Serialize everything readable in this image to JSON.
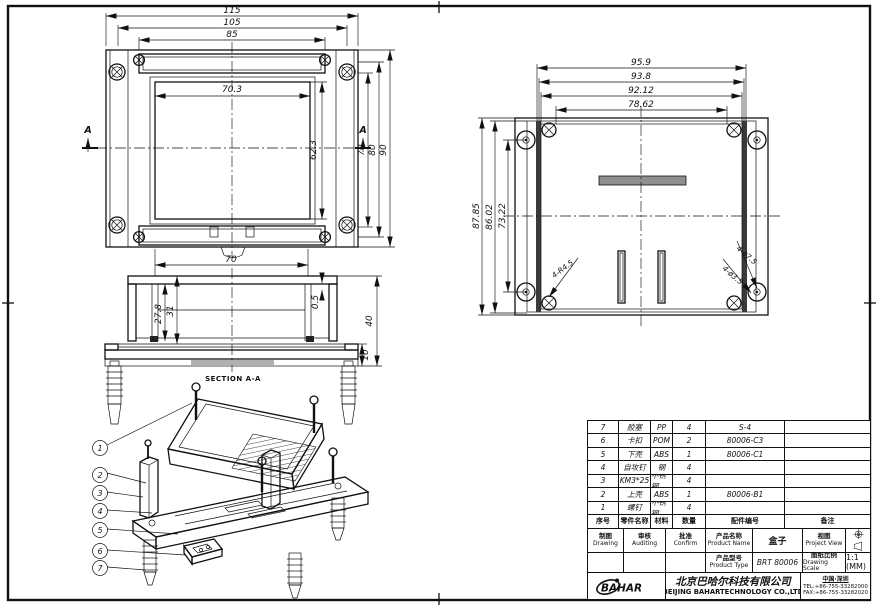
{
  "page": {
    "bg": "#ffffff",
    "line_color": "#111111"
  },
  "dims": {
    "top_view": {
      "overall_w": "115",
      "lid_w": "105",
      "slot_w": "85",
      "inner_w": "70.3",
      "inner_h": "62.3",
      "h1": "70",
      "h2": "80",
      "h3": "90",
      "bottom_w": "70",
      "section_letter": "A"
    },
    "bottom_view": {
      "w1": "95.9",
      "w2": "93.8",
      "w3": "92.12",
      "w4": "78.62",
      "h1": "87.85",
      "h2": "86.02",
      "h3": "73.22",
      "corner_radius": "4-R4.5",
      "boss_dia": "4-ø7.5",
      "hole_dia": "4-ø3.5"
    },
    "section_view": {
      "label": "SECTION A-A",
      "top_w": "70",
      "depth1": "27.8",
      "depth2": "31",
      "gap": "0.5",
      "total_h": "40",
      "base_h": "10"
    }
  },
  "balloons": [
    "1",
    "2",
    "3",
    "4",
    "5",
    "6",
    "7"
  ],
  "bom": {
    "headers": [
      "序号",
      "零件名称",
      "材料",
      "数量",
      "配件编号",
      "备注"
    ],
    "rows": [
      [
        "7",
        "胶塞",
        "PP",
        "4",
        "S-4",
        ""
      ],
      [
        "6",
        "卡扣",
        "POM",
        "2",
        "80006-C3",
        ""
      ],
      [
        "5",
        "下壳",
        "ABS",
        "1",
        "80006-C1",
        ""
      ],
      [
        "4",
        "自攻钉",
        "钢",
        "4",
        "",
        ""
      ],
      [
        "3",
        "KM3*25",
        "不锈钢",
        "4",
        "",
        ""
      ],
      [
        "2",
        "上壳",
        "ABS",
        "1",
        "80006-B1",
        ""
      ],
      [
        "1",
        "螺钉",
        "不锈钢",
        "4",
        "",
        ""
      ]
    ]
  },
  "title_block": {
    "drawing_cn": "制图",
    "drawing_en": "Drawing",
    "auditing_cn": "审核",
    "auditing_en": "Auditing",
    "confirm_cn": "批准",
    "confirm_en": "Confirm",
    "product_name_cn": "产品名称",
    "product_name_en": "Product Name",
    "product_name_value": "盒子",
    "project_view_cn": "视图",
    "project_view_en": "Project View",
    "product_type_cn": "产品型号",
    "product_type_en": "Product Type",
    "product_type_value": "BRT 80006",
    "scale_cn": "图纸比例",
    "scale_en": "Drawing Scale",
    "scale_value": "1:1 (MM)",
    "logo_text": "BAHAR",
    "company_cn": "北京巴哈尔科技有限公司",
    "company_en": "BEIJING BAHARTECHNOLOGY CO.,LTD",
    "location": "中国·深圳",
    "tel": "TEL:+86-755-33282000",
    "fax": "FAX:+86-755-33282020"
  }
}
